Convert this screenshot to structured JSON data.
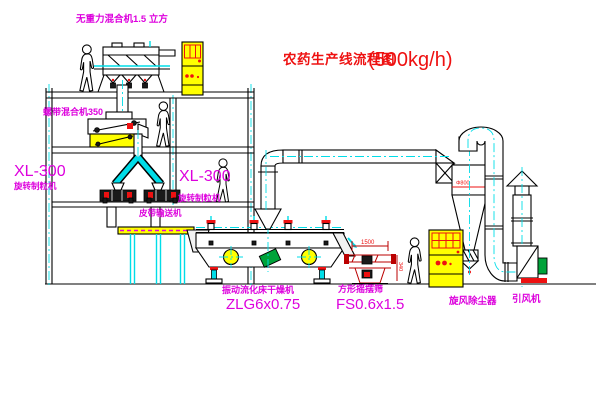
{
  "title": {
    "cn": "农药生产线流程图",
    "capacity": "(500kg/h)"
  },
  "labels": {
    "top_mixer": "无重力混合机1.5 立方",
    "mid_mixer": "螺带混合机350",
    "xl300_left": "XL-300",
    "granulator_left": "旋转制粒机",
    "xl300_right": "XL-300",
    "granulator_right": "旋转制粒机",
    "belt_conveyor": "皮带输送机",
    "dryer_name": "振动流化床干燥机",
    "dryer_model": "ZLG6x0.75",
    "sieve_name": "方形摇摆筛",
    "sieve_model": "FS0.6x1.5",
    "cyclone": "旋风除尘器",
    "fan": "引风机"
  },
  "dimensions": {
    "cyclone_diameter": "Φ800",
    "sieve_length": "1500",
    "sieve_height": "340"
  },
  "colors": {
    "background": "#ffffff",
    "line": "#000000",
    "label_magenta": "#dd00dd",
    "title_red": "#ee1111",
    "centerline_cyan": "#00dde8",
    "cabinet_yellow": "#ffff00",
    "motor_green": "#00a33a"
  }
}
